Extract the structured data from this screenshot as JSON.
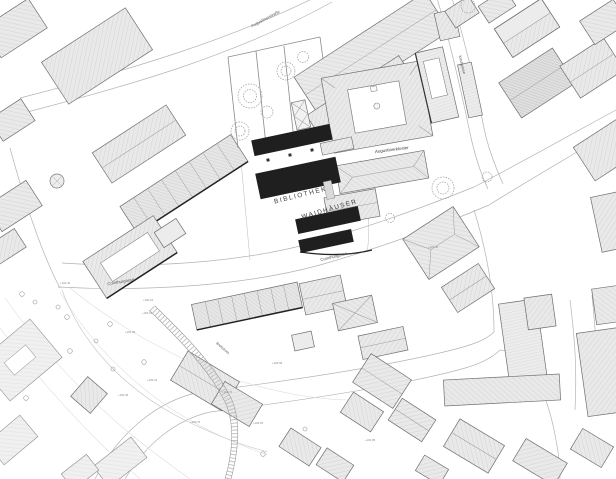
{
  "map": {
    "labels": {
      "bibliothek": "BIBLIOTHEK",
      "waidhaeuser": "WAIDHÄUSER",
      "augustinerkloster": "Augustinerkloster",
      "comthurgasse_west": "Comthurgasse",
      "comthurgasse_east": "Comthurgasse",
      "augustinerstrasse": "Augustinerstraße",
      "kirchgasse": "Kirchgasse",
      "breitstrom": "Breitstrom"
    },
    "spot_elevations": [
      {
        "t": "+182.45"
      },
      {
        "t": "+182.21"
      },
      {
        "t": "+182.63"
      },
      {
        "t": "+181.98"
      },
      {
        "t": "+182.10"
      },
      {
        "t": "+182.35"
      },
      {
        "t": "+182.72"
      },
      {
        "t": "+182.05"
      },
      {
        "t": "+182.58"
      },
      {
        "t": "+181.85"
      },
      {
        "t": "+182.30"
      },
      {
        "t": "+182.15"
      }
    ]
  },
  "colors": {
    "background": "#ffffff",
    "building_fill": "#e9e9e9",
    "building_stroke": "#6e6e6e",
    "new_building_fill": "#1f1f1f",
    "hatch_line": "#c6c6c6",
    "road_line": "#b3b3b3",
    "label_text": "#3c3c3c"
  }
}
